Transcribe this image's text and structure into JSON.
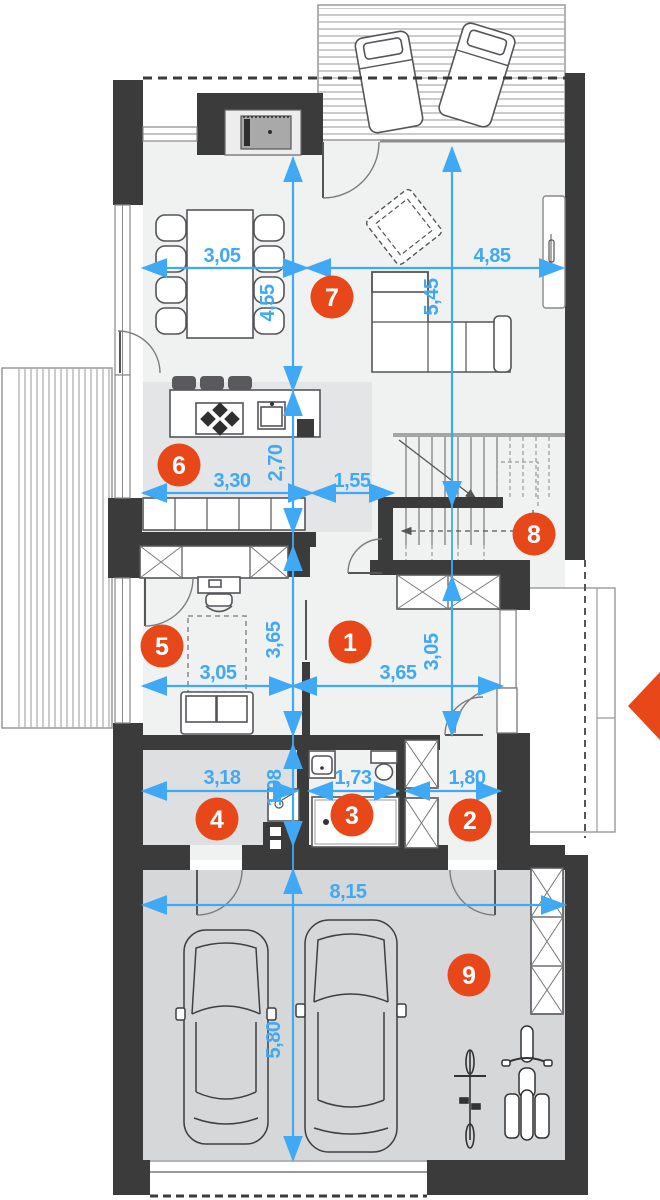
{
  "plan": {
    "type": "residential-floor-plan",
    "level": "ground-floor"
  },
  "colors": {
    "wall": "#3b3b3c",
    "interior_floor": "#f0f1f1",
    "kitchen_floor": "#e4e5e6",
    "utility_floor": "#dedfe0",
    "garage_floor": "#d6d7d8",
    "dimension_blue": "#3fa9f5",
    "badge_orange": "#e8471a",
    "entrance_arrow": "#e8471a"
  },
  "rooms": [
    {
      "number": "1"
    },
    {
      "number": "2"
    },
    {
      "number": "3"
    },
    {
      "number": "4"
    },
    {
      "number": "5"
    },
    {
      "number": "6"
    },
    {
      "number": "7"
    },
    {
      "number": "8"
    },
    {
      "number": "9"
    }
  ],
  "dimensions": {
    "dining_width": "3,05",
    "living_width": "4,85",
    "dining_height": "4,55",
    "living_height": "5,45",
    "kitchen_width": "3,30",
    "kitchen_height": "2,70",
    "stairs_width": "1,55",
    "study_width": "3,05",
    "study_height": "3,65",
    "hall_width": "3,65",
    "hall_height": "3,05",
    "utility_width": "3,18",
    "utility_height": "1,98",
    "bath_width": "1,73",
    "vestibule_width": "1,80",
    "garage_width": "8,15",
    "garage_height": "5,80"
  }
}
